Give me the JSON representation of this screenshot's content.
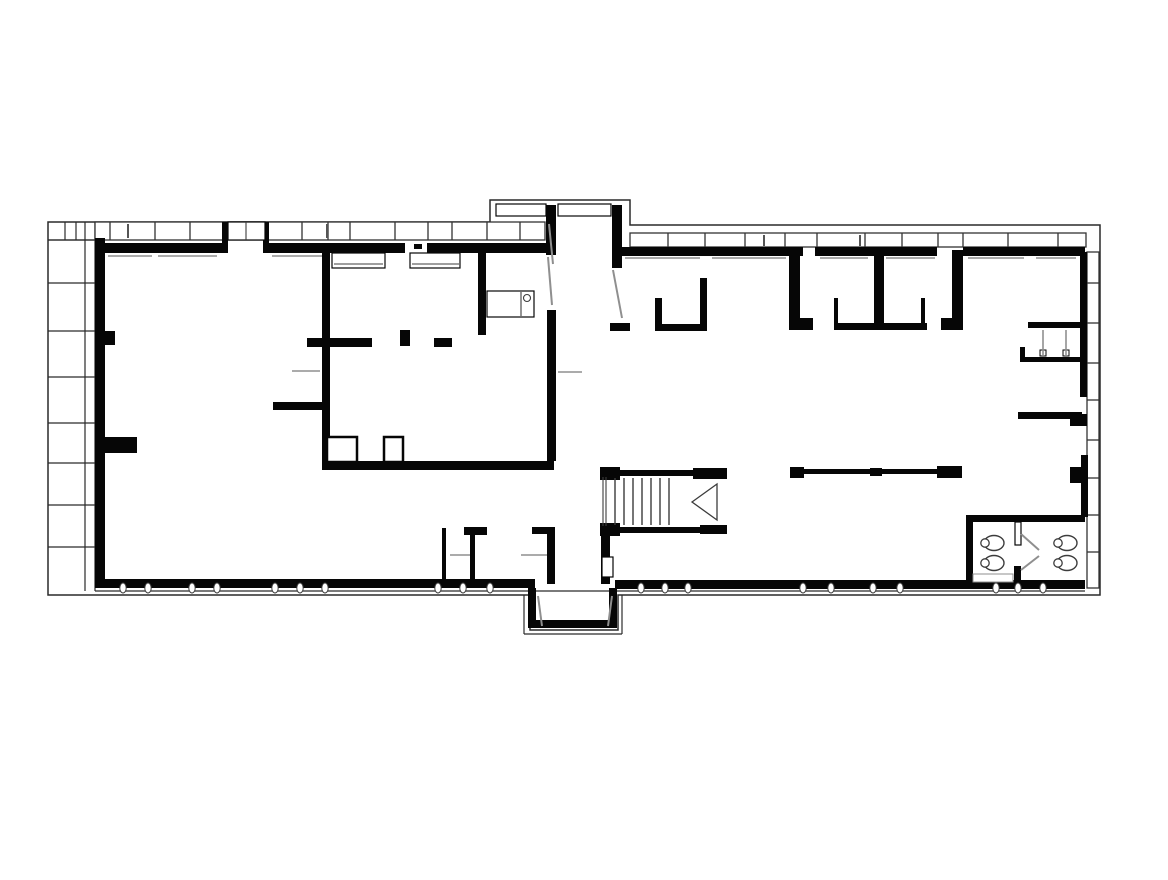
{
  "meta": {
    "type": "architectural-floor-plan",
    "background": "#ffffff"
  },
  "colors": {
    "wall": "#060606",
    "boundary": "#2a2a2a",
    "band": "#333333",
    "detail": "#3c3c3c",
    "gray": "#8f8f8f",
    "light": "#c0c0c0"
  },
  "plan": {
    "width": 1168,
    "height": 880,
    "outer_path": "M48,222 L490,222 L490,200 L630,200 L630,225 L1100,225 L1100,595 L618,595 L618,630 L530,630 L530,595 L48,595 Z",
    "inner_lines": [
      [
        85,
        222,
        85,
        591
      ],
      [
        95,
        591,
        1085,
        591
      ],
      [
        524,
        595,
        524,
        634
      ],
      [
        524,
        634,
        622,
        634
      ],
      [
        622,
        634,
        622,
        595
      ],
      [
        48,
        240,
        95,
        240
      ]
    ],
    "strip": {
      "x1": 48,
      "x2": 95,
      "rows_y": [
        240,
        283,
        331,
        377,
        423,
        463,
        505,
        547
      ],
      "top_cell_x": [
        65,
        76
      ],
      "top_cell_y1": 222,
      "top_cell_y2": 240
    },
    "window_bands": {
      "top_left": {
        "x1": 95,
        "y1": 222,
        "x2": 545,
        "y2": 240,
        "mullions": [
          110,
          155,
          190,
          302,
          328,
          350,
          395,
          428,
          452,
          487,
          520
        ]
      },
      "top_right": {
        "x1": 630,
        "y1": 233,
        "x2": 1086,
        "y2": 247,
        "mullions": [
          668,
          705,
          745,
          785,
          817,
          865,
          902,
          938,
          963,
          1008,
          1058
        ]
      },
      "right_vertical": {
        "x1": 1087,
        "y1": 252,
        "x2": 1099,
        "y2": 588,
        "mullions_y": [
          283,
          323,
          363,
          400,
          440,
          478,
          515,
          552
        ]
      }
    },
    "glazing_ticks": [
      [
        128,
        224,
        128,
        238
      ],
      [
        327,
        224,
        327,
        238
      ],
      [
        563,
        206,
        563,
        214
      ],
      [
        764,
        235,
        764,
        246
      ],
      [
        860,
        235,
        860,
        246
      ]
    ],
    "walls": [
      [
        105,
        243,
        118,
        10
      ],
      [
        265,
        243,
        140,
        10
      ],
      [
        427,
        243,
        120,
        10
      ],
      [
        222,
        222,
        6,
        31
      ],
      [
        263,
        222,
        6,
        31
      ],
      [
        414,
        244,
        8,
        5
      ],
      [
        95,
        238,
        10,
        350
      ],
      [
        95,
        331,
        20,
        14
      ],
      [
        100,
        437,
        37,
        16
      ],
      [
        273,
        402,
        49,
        8
      ],
      [
        307,
        338,
        65,
        9
      ],
      [
        322,
        247,
        8,
        214
      ],
      [
        434,
        338,
        18,
        9
      ],
      [
        400,
        330,
        10,
        16
      ],
      [
        478,
        252,
        8,
        83
      ],
      [
        322,
        461,
        232,
        9
      ],
      [
        546,
        205,
        10,
        50
      ],
      [
        547,
        310,
        9,
        151
      ],
      [
        612,
        205,
        10,
        63
      ],
      [
        610,
        323,
        20,
        8
      ],
      [
        655,
        298,
        7,
        33
      ],
      [
        655,
        324,
        50,
        7
      ],
      [
        700,
        278,
        7,
        53
      ],
      [
        618,
        247,
        185,
        9
      ],
      [
        815,
        247,
        122,
        9
      ],
      [
        963,
        247,
        122,
        9
      ],
      [
        789,
        250,
        11,
        80
      ],
      [
        789,
        318,
        24,
        12
      ],
      [
        874,
        250,
        10,
        80
      ],
      [
        952,
        250,
        11,
        70
      ],
      [
        941,
        318,
        22,
        12
      ],
      [
        834,
        323,
        93,
        7
      ],
      [
        834,
        298,
        4,
        32
      ],
      [
        921,
        298,
        4,
        32
      ],
      [
        1028,
        322,
        55,
        6
      ],
      [
        1020,
        347,
        5,
        15
      ],
      [
        1020,
        357,
        63,
        5
      ],
      [
        1018,
        412,
        64,
        7
      ],
      [
        1070,
        414,
        17,
        12
      ],
      [
        1080,
        252,
        7,
        145
      ],
      [
        1081,
        455,
        7,
        62
      ],
      [
        1070,
        467,
        13,
        16
      ],
      [
        790,
        467,
        14,
        11
      ],
      [
        870,
        468,
        12,
        8
      ],
      [
        937,
        466,
        25,
        12
      ],
      [
        804,
        469,
        66,
        5
      ],
      [
        882,
        469,
        55,
        5
      ],
      [
        600,
        467,
        20,
        13
      ],
      [
        618,
        470,
        76,
        6
      ],
      [
        693,
        468,
        34,
        11
      ],
      [
        600,
        523,
        20,
        13
      ],
      [
        618,
        527,
        100,
        6
      ],
      [
        700,
        525,
        27,
        9
      ],
      [
        601,
        534,
        9,
        50
      ],
      [
        966,
        515,
        119,
        7
      ],
      [
        966,
        515,
        7,
        70
      ],
      [
        1014,
        566,
        7,
        17
      ],
      [
        528,
        588,
        8,
        38
      ],
      [
        609,
        588,
        8,
        38
      ],
      [
        528,
        620,
        89,
        8
      ],
      [
        95,
        579,
        440,
        9
      ],
      [
        615,
        580,
        470,
        9
      ],
      [
        442,
        528,
        4,
        52
      ],
      [
        470,
        535,
        5,
        45
      ],
      [
        464,
        527,
        23,
        8
      ],
      [
        547,
        527,
        8,
        57
      ],
      [
        532,
        527,
        23,
        7
      ]
    ],
    "outlined_rects": [
      {
        "x": 327,
        "y": 437,
        "w": 30,
        "h": 25,
        "sw": 2.5
      },
      {
        "x": 384,
        "y": 437,
        "w": 19,
        "h": 25,
        "sw": 2.5
      },
      {
        "x": 332,
        "y": 253,
        "w": 53,
        "h": 15,
        "sw": 1.2
      },
      {
        "x": 410,
        "y": 253,
        "w": 50,
        "h": 15,
        "sw": 1.2
      },
      {
        "x": 487,
        "y": 291,
        "w": 47,
        "h": 26,
        "sw": 1.2
      },
      {
        "x": 602,
        "y": 557,
        "w": 11,
        "h": 20,
        "sw": 1.2
      },
      {
        "x": 1015,
        "y": 522,
        "w": 6,
        "h": 23,
        "sw": 1.2
      },
      {
        "x": 496,
        "y": 204,
        "w": 50,
        "h": 12,
        "sw": 1.2
      },
      {
        "x": 558,
        "y": 204,
        "w": 53,
        "h": 12,
        "sw": 1.2
      },
      {
        "x": 228,
        "y": 222,
        "w": 37,
        "h": 18,
        "sw": 1.2
      },
      {
        "x": 973,
        "y": 574,
        "w": 40,
        "h": 8,
        "sw": 1,
        "c": "#8f8f8f"
      },
      {
        "x": 1040,
        "y": 350,
        "w": 6,
        "h": 6,
        "sw": 1
      },
      {
        "x": 1063,
        "y": 350,
        "w": 6,
        "h": 6,
        "sw": 1
      }
    ],
    "detail_lines": [
      [
        246,
        222,
        246,
        240
      ],
      [
        334,
        264,
        383,
        264
      ],
      [
        412,
        264,
        459,
        264
      ],
      [
        521,
        292,
        521,
        316
      ],
      [
        603,
        477,
        603,
        526
      ],
      [
        606,
        477,
        606,
        526
      ]
    ],
    "gray_lines": [
      [
        292,
        371,
        320,
        371
      ],
      [
        558,
        372,
        582,
        372
      ],
      [
        450,
        555,
        470,
        555
      ],
      [
        521,
        555,
        547,
        555
      ],
      [
        1043,
        330,
        1043,
        356
      ],
      [
        1066,
        330,
        1066,
        356
      ]
    ],
    "sills": [
      [
        108,
        256,
        152,
        256
      ],
      [
        158,
        256,
        217,
        256
      ],
      [
        272,
        256,
        330,
        256
      ],
      [
        625,
        258,
        700,
        258
      ],
      [
        712,
        258,
        786,
        258
      ],
      [
        820,
        258,
        868,
        258
      ],
      [
        886,
        258,
        935,
        258
      ],
      [
        968,
        258,
        1024,
        258
      ],
      [
        1036,
        258,
        1076,
        258
      ]
    ],
    "door_leaves": [
      [
        549,
        224,
        553,
        264
      ],
      [
        548,
        257,
        552,
        305
      ],
      [
        613,
        270,
        622,
        318
      ],
      [
        1021,
        534,
        1039,
        550
      ],
      [
        1021,
        570,
        1039,
        556
      ],
      [
        538,
        596,
        542,
        626
      ],
      [
        612,
        596,
        608,
        626
      ]
    ],
    "stairs": {
      "tread_xs": [
        615,
        624,
        633,
        642,
        651,
        660,
        669
      ],
      "tread_y1": 478,
      "tread_y2": 525
    },
    "arrow_points": "692,502 717,484 717,520",
    "bottom_ticks": {
      "cy": 588,
      "rx": 3.2,
      "ry": 5,
      "cxs": [
        123,
        148,
        192,
        217,
        275,
        300,
        325,
        438,
        463,
        490,
        641,
        665,
        688,
        803,
        831,
        873,
        900,
        996,
        1018,
        1043
      ]
    },
    "toilets": [
      {
        "cx": 991,
        "cy": 543
      },
      {
        "cx": 991,
        "cy": 563
      },
      {
        "cx": 1064,
        "cy": 543
      },
      {
        "cx": 1064,
        "cy": 563
      }
    ],
    "circles": [
      [
        527,
        298,
        3.5
      ]
    ]
  }
}
